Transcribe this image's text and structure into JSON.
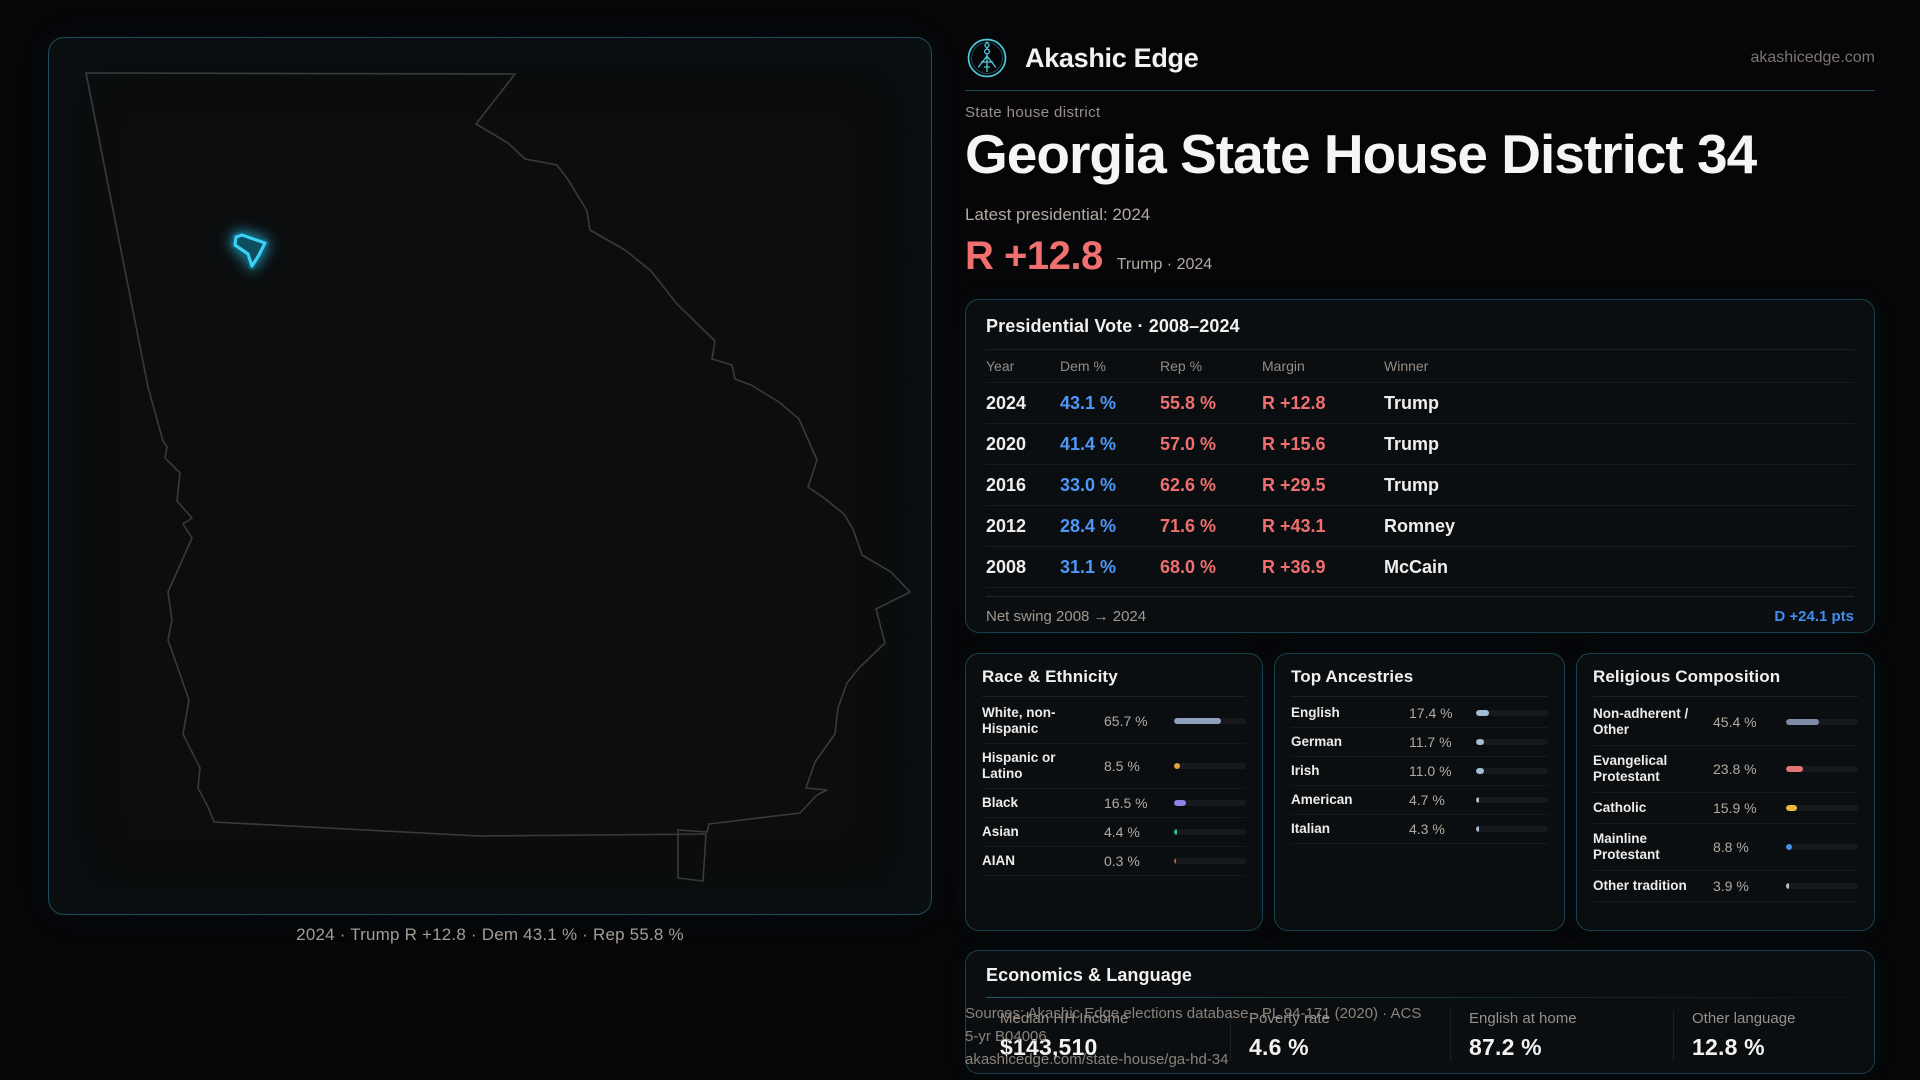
{
  "brand": {
    "name": "Akashic Edge",
    "domain": "akashicedge.com"
  },
  "page": {
    "eyebrow": "State house district",
    "title": "Georgia State House District 34",
    "latest_label": "Latest presidential: 2024",
    "margin_value": "R +12.8",
    "margin_context": "Trump · 2024"
  },
  "map": {
    "caption": "2024 · Trump R +12.8 · Dem 43.1 % · Rep 55.8 %"
  },
  "presidential": {
    "title": "Presidential Vote · 2008–2024",
    "columns": [
      "Year",
      "Dem %",
      "Rep %",
      "Margin",
      "Winner"
    ],
    "rows": [
      {
        "year": "2024",
        "dem": "43.1 %",
        "rep": "55.8 %",
        "margin": "R +12.8",
        "winner": "Trump"
      },
      {
        "year": "2020",
        "dem": "41.4 %",
        "rep": "57.0 %",
        "margin": "R +15.6",
        "winner": "Trump"
      },
      {
        "year": "2016",
        "dem": "33.0 %",
        "rep": "62.6 %",
        "margin": "R +29.5",
        "winner": "Trump"
      },
      {
        "year": "2012",
        "dem": "28.4 %",
        "rep": "71.6 %",
        "margin": "R +43.1",
        "winner": "Romney"
      },
      {
        "year": "2008",
        "dem": "31.1 %",
        "rep": "68.0 %",
        "margin": "R +36.9",
        "winner": "McCain"
      }
    ],
    "footer_label": "Net swing 2008 → 2024",
    "footer_value": "D +24.1 pts"
  },
  "race": {
    "title": "Race & Ethnicity",
    "rows": [
      {
        "label": "White, non-Hispanic",
        "value": "65.7 %",
        "pct": 65.7,
        "color": "#8fa0bf"
      },
      {
        "label": "Hispanic or Latino",
        "value": "8.5 %",
        "pct": 8.5,
        "color": "#e2a43e"
      },
      {
        "label": "Black",
        "value": "16.5 %",
        "pct": 16.5,
        "color": "#8f82e8"
      },
      {
        "label": "Asian",
        "value": "4.4 %",
        "pct": 4.4,
        "color": "#2fbd8e"
      },
      {
        "label": "AIAN",
        "value": "0.3 %",
        "pct": 0.3,
        "color": "#b9602f"
      }
    ]
  },
  "ancestries": {
    "title": "Top Ancestries",
    "rows": [
      {
        "label": "English",
        "value": "17.4 %",
        "pct": 17.4,
        "color": "#a3bdd2"
      },
      {
        "label": "German",
        "value": "11.7 %",
        "pct": 11.7,
        "color": "#a3bdd2"
      },
      {
        "label": "Irish",
        "value": "11.0 %",
        "pct": 11.0,
        "color": "#a3bdd2"
      },
      {
        "label": "American",
        "value": "4.7 %",
        "pct": 4.7,
        "color": "#a3bdd2"
      },
      {
        "label": "Italian",
        "value": "4.3 %",
        "pct": 4.3,
        "color": "#a3bdd2"
      }
    ]
  },
  "religion": {
    "title": "Religious Composition",
    "rows": [
      {
        "label": "Non-adherent / Other",
        "value": "45.4 %",
        "pct": 45.4,
        "color": "#7e8ba6"
      },
      {
        "label": "Evangelical Protestant",
        "value": "23.8 %",
        "pct": 23.8,
        "color": "#e27676"
      },
      {
        "label": "Catholic",
        "value": "15.9 %",
        "pct": 15.9,
        "color": "#e9b83f"
      },
      {
        "label": "Mainline Protestant",
        "value": "8.8 %",
        "pct": 8.8,
        "color": "#4a90ea"
      },
      {
        "label": "Other tradition",
        "value": "3.9 %",
        "pct": 3.9,
        "color": "#bcc1c6"
      }
    ]
  },
  "economics": {
    "title": "Economics & Language",
    "stats": [
      {
        "label": "Median HH Income",
        "value": "$143,510"
      },
      {
        "label": "Poverty rate",
        "value": "4.6 %"
      },
      {
        "label": "English at home",
        "value": "87.2 %"
      },
      {
        "label": "Other language",
        "value": "12.8 %"
      }
    ]
  },
  "sources": {
    "line1": "Sources: Akashic Edge elections database · PL 94-171 (2020) · ACS 5-yr B04006",
    "line2": "akashicedge.com/state-house/ga-hd-34"
  },
  "colors": {
    "accent_cyan": "#35cbea",
    "dem_blue": "#4f97f7",
    "rep_red": "#ef6f6f",
    "margin_red": "#f06f6f",
    "swing_blue": "#3f8ef0",
    "panel_border": "#17424d"
  }
}
